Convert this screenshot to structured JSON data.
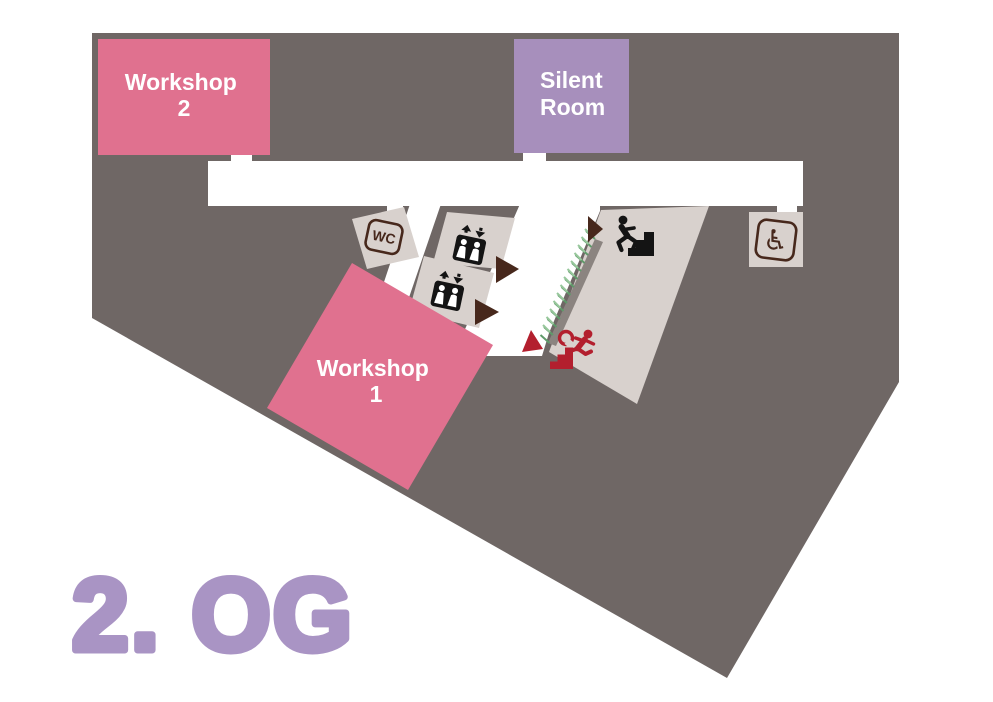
{
  "map": {
    "floor_label": "2. OG",
    "rooms": {
      "workshop_2": {
        "line1": "Workshop",
        "line2": "2"
      },
      "silent_room": {
        "line1": "Silent",
        "line2": "Room"
      },
      "workshop_1": {
        "line1": "Workshop",
        "line2": "1"
      }
    },
    "badges": {
      "wc": "WC",
      "accessible_symbol": "♿"
    },
    "icons": [
      "wc-badge",
      "elevator-icon",
      "elevator-icon",
      "stairs-up-icon",
      "emergency-exit-icon",
      "wheelchair-icon",
      "direction-arrow",
      "exit-arrow"
    ],
    "colors": {
      "floor_dark": "#6f6765",
      "room_beige": "#d8d1cd",
      "room_pink": "#e0718f",
      "room_purple": "#a78fbc",
      "wall_gray": "#8b8480",
      "icon_brown": "#47281c",
      "exit_red": "#b31f2e",
      "hatch_green_dark": "#5f9a6a",
      "hatch_green_light": "#97c79b",
      "icon_black": "#141414",
      "floor_label_purple": "#a994c4",
      "corridor_white": "#ffffff"
    }
  }
}
